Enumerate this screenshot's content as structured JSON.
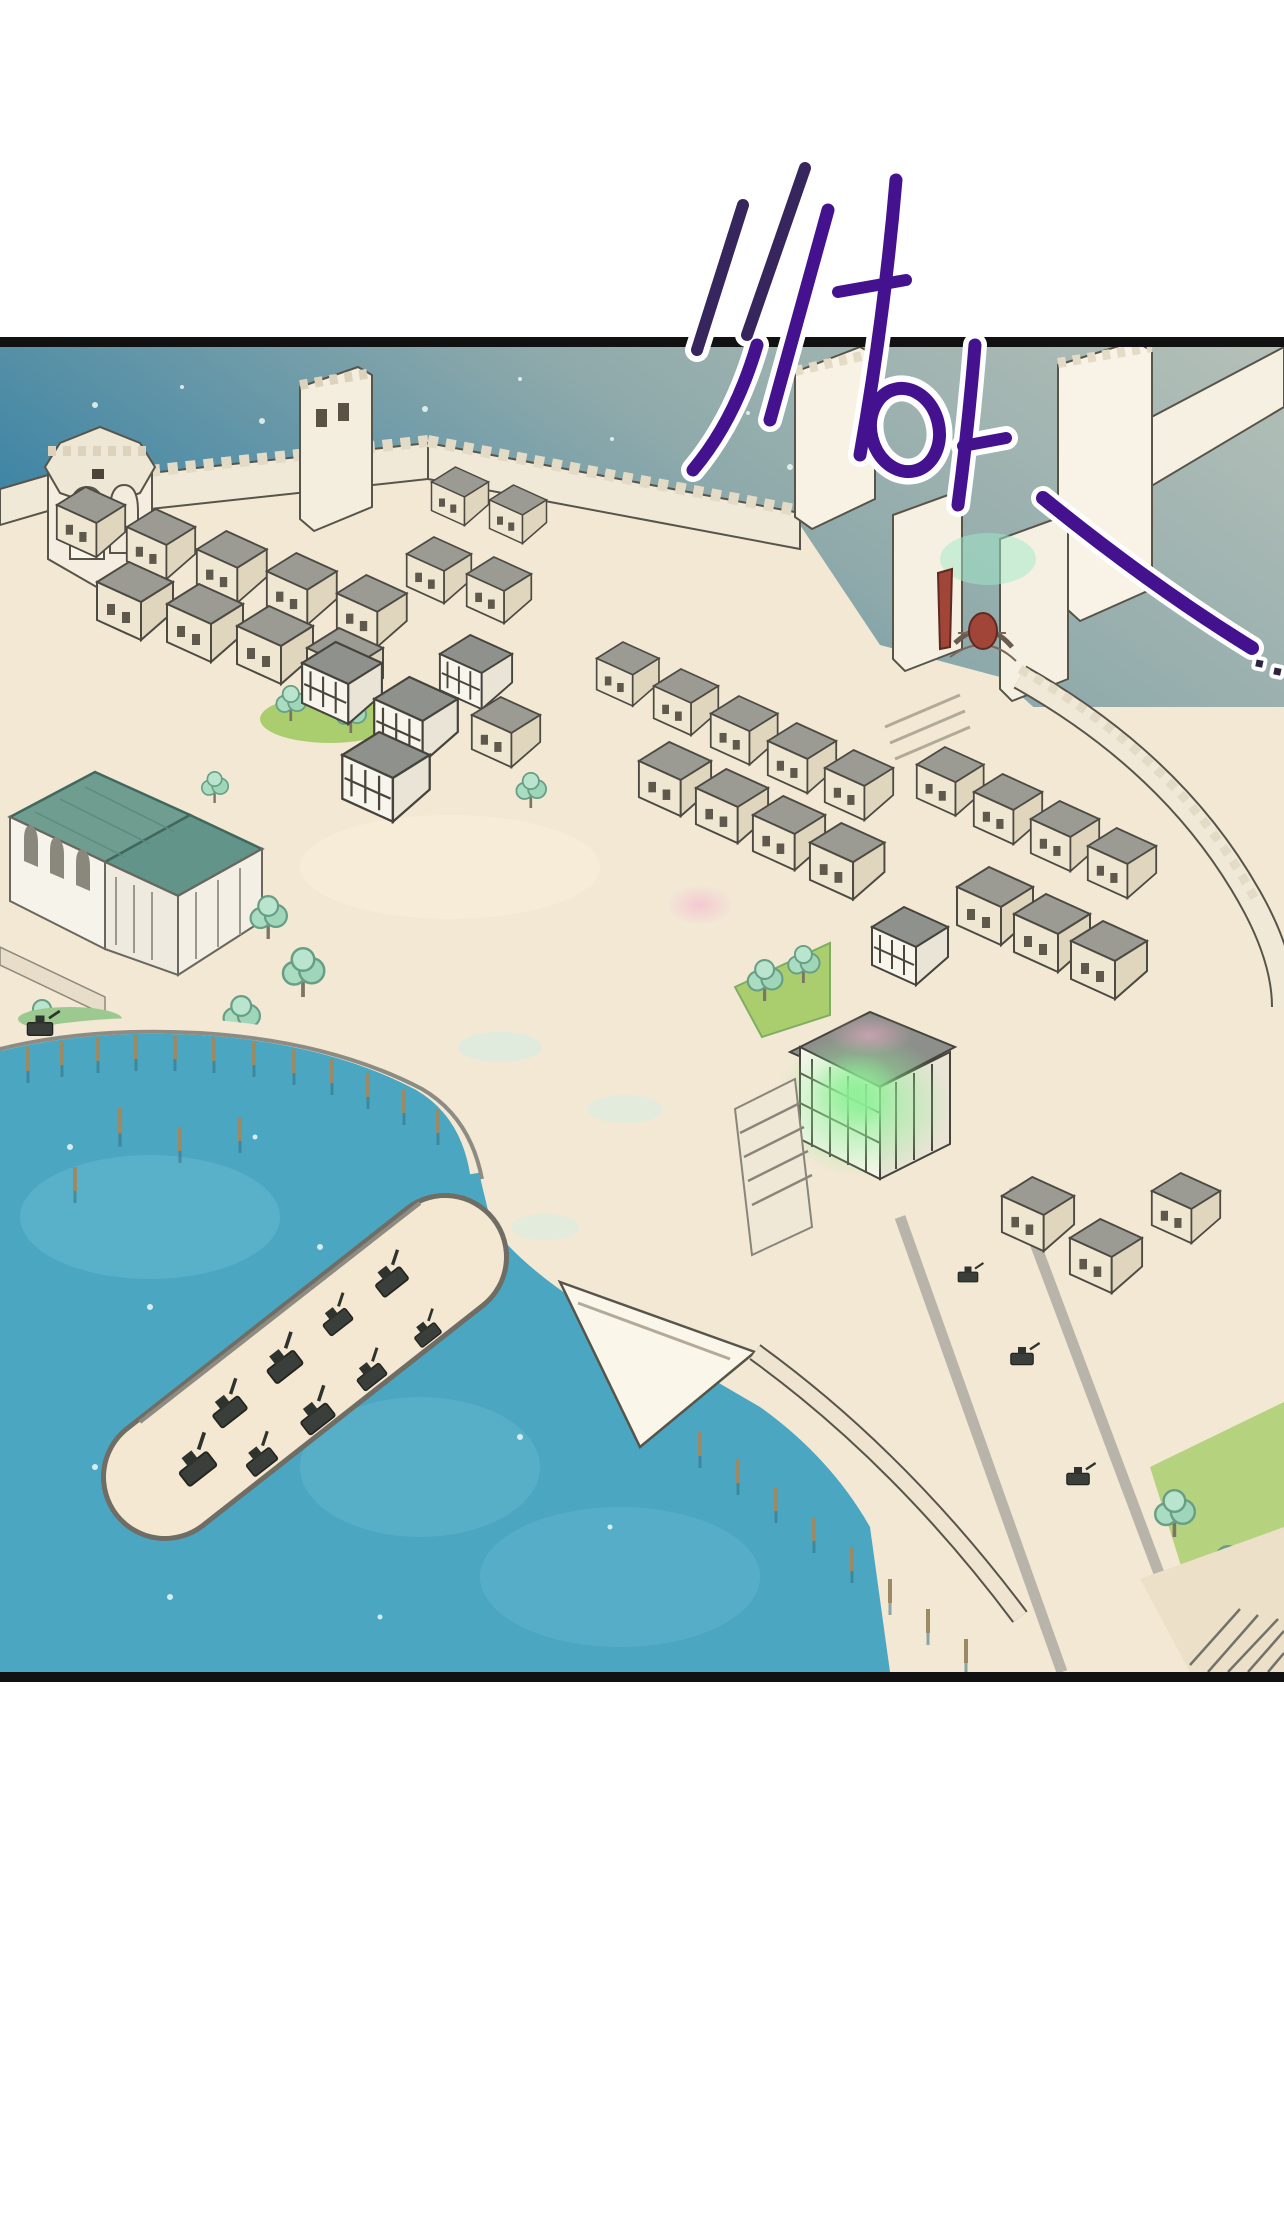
{
  "sfx": {
    "main_syllable": "쏴",
    "second_syllable": "아",
    "trailing_dots": ".."
  },
  "watermark": {
    "title": "최신 웹툰",
    "tagline": {
      "the1": "THE",
      "word1": "빠르고",
      "the2": "THE",
      "word2": "편하게"
    },
    "buttons": {
      "google": {
        "label": "구글검색"
      },
      "toonbook": {
        "label": "툰북"
      }
    }
  },
  "colors": {
    "panel-border": "#111111",
    "sfx-purple": "#45128f",
    "sfx-indigo": "#37265e",
    "sea-deep": "#3e85a5",
    "sea-mid": "#8faaab",
    "sea-haze": "#b5c0b8",
    "water": "#4ba6c2",
    "water-light": "#66b8cf",
    "sand": "#f2e8d4",
    "stone": "#f1e9d7",
    "roof-gray": "#9b9b93",
    "mansion-roof": "#6f9e90",
    "tree-green": "#a9dcc0",
    "grass": "#aace6e",
    "glow-green": "#8ef096",
    "banner-red": "#a14538",
    "watermark-navy": "#20336f",
    "watermark-blue": "#a5d2ec",
    "toonbook-blue": "#2f6fd0"
  }
}
